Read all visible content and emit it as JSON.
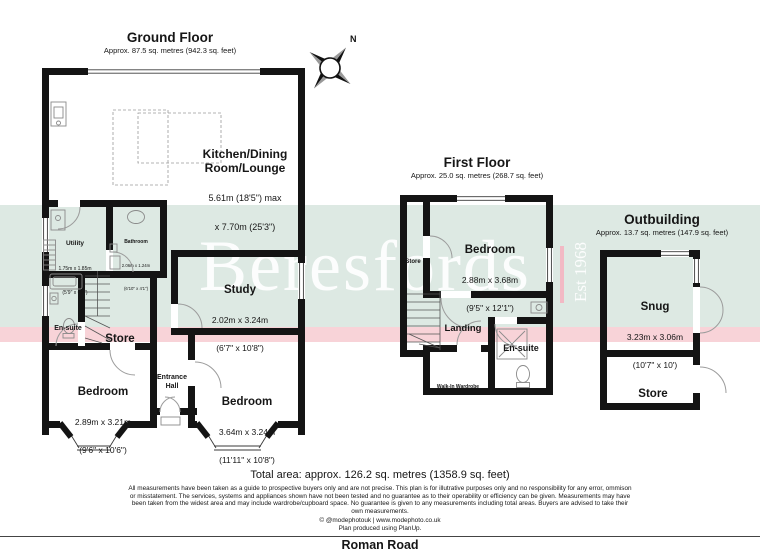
{
  "brand": {
    "watermark": "Beresfords",
    "established": "Est 1968"
  },
  "compass": {
    "north_label": "N"
  },
  "floors": {
    "ground": {
      "title": "Ground Floor",
      "area": "Approx. 87.5 sq. metres (942.3 sq. feet)"
    },
    "first": {
      "title": "First Floor",
      "area": "Approx. 25.0 sq. metres (268.7 sq. feet)"
    },
    "outbuilding": {
      "title": "Outbuilding",
      "area": "Approx. 13.7 sq. metres (147.9 sq. feet)"
    }
  },
  "rooms": {
    "kitchen": {
      "name": "Kitchen/Dining\nRoom/Lounge",
      "metric": "5.61m (18'5\") max",
      "imperial": "x 7.70m (25'3\")"
    },
    "utility": {
      "name": "Utility",
      "metric": "1.75m x 1.85m",
      "imperial": "(5'9\" x 6'1\")"
    },
    "bathroom": {
      "name": "Bathroom",
      "metric": "2.06m x 1.24m",
      "imperial": "(6'10\" x 4'1\")"
    },
    "study": {
      "name": "Study",
      "metric": "2.02m x 3.24m",
      "imperial": "(6'7\" x 10'8\")"
    },
    "ensuite_ground": {
      "name": "En-suite"
    },
    "store_ground": {
      "name": "Store"
    },
    "entrance_hall": {
      "name": "Entrance\nHall"
    },
    "bedroom_ground_left": {
      "name": "Bedroom",
      "metric": "2.89m x 3.21m",
      "imperial": "(9'6\" x 10'6\")"
    },
    "bedroom_ground_right": {
      "name": "Bedroom",
      "metric": "3.64m x 3.24m",
      "imperial": "(11'11\" x 10'8\")"
    },
    "store_first": {
      "name": "Store"
    },
    "bedroom_first": {
      "name": "Bedroom",
      "metric": "2.88m x 3.68m",
      "imperial": "(9'5\" x 12'1\")"
    },
    "landing": {
      "name": "Landing"
    },
    "ensuite_first": {
      "name": "En-suite"
    },
    "wardrobe": {
      "name": "Walk-In Wardrobe"
    },
    "snug": {
      "name": "Snug",
      "metric": "3.23m x 3.06m",
      "imperial": "(10'7\" x 10')"
    },
    "store_outbuilding": {
      "name": "Store"
    }
  },
  "footer": {
    "total_area": "Total area: approx. 126.2 sq. metres (1358.9 sq. feet)",
    "disclaimer": "All measurements have been taken as a guide to prospective buyers only and are not precise. This plan is for illutrative purposes only and no responsibility for any error, ommison\nor misstatement. The services, systems and appliances shown have not been tested and no guarantee as to their operability or efficiency can be given. Measurements may have\nbeen taken from the widest area and may include wardrobe/cupboard space. No guarantee is given to any measurements including total areas. Buyers are advised to take their\nown measurements.",
    "credit": "© @modephotouk | www.modephoto.co.uk",
    "software": "Plan produced using PlanUp.",
    "street": "Roman Road"
  },
  "colors": {
    "wall": "#141414",
    "band_green": "#dde9e3",
    "band_pink": "#f8d3d8",
    "accent_pink": "#f2b9c4"
  }
}
